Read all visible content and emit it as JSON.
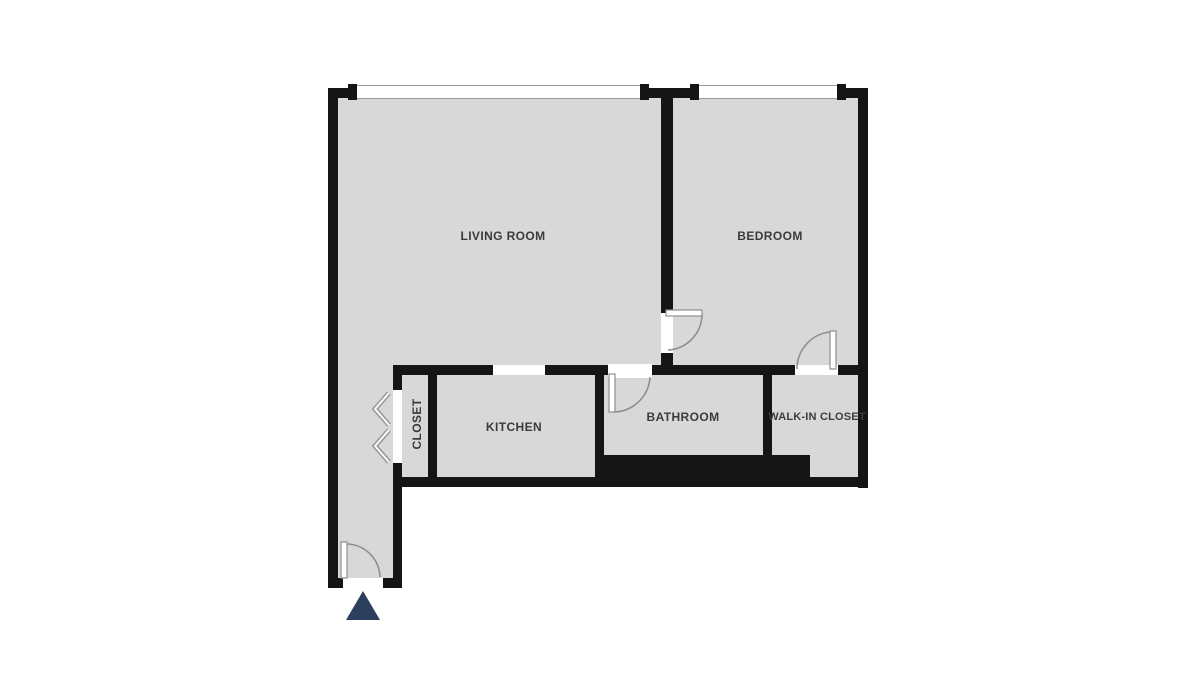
{
  "type": "floor_plan",
  "rooms": {
    "living_room": {
      "label": "LIVING ROOM"
    },
    "bedroom": {
      "label": "BEDROOM"
    },
    "kitchen": {
      "label": "KITCHEN"
    },
    "bathroom": {
      "label": "BATHROOM"
    },
    "walk_in_closet": {
      "label": "WALK-IN CLOSET"
    },
    "closet": {
      "label": "CLOSET"
    }
  },
  "features": {
    "windows": [
      "living-room-window",
      "bedroom-window"
    ],
    "doors": [
      "entry-door",
      "bedroom-door",
      "bathroom-door",
      "walk-in-closet-door",
      "closet-bifold-door"
    ],
    "entrance_marker": "triangle"
  },
  "colors": {
    "wall": "#151515",
    "floor": "#d8d8d8",
    "background": "#ffffff",
    "door_line": "#8f8f8f",
    "label": "#3b3b3b",
    "entrance_marker": "#2d3f5e"
  }
}
